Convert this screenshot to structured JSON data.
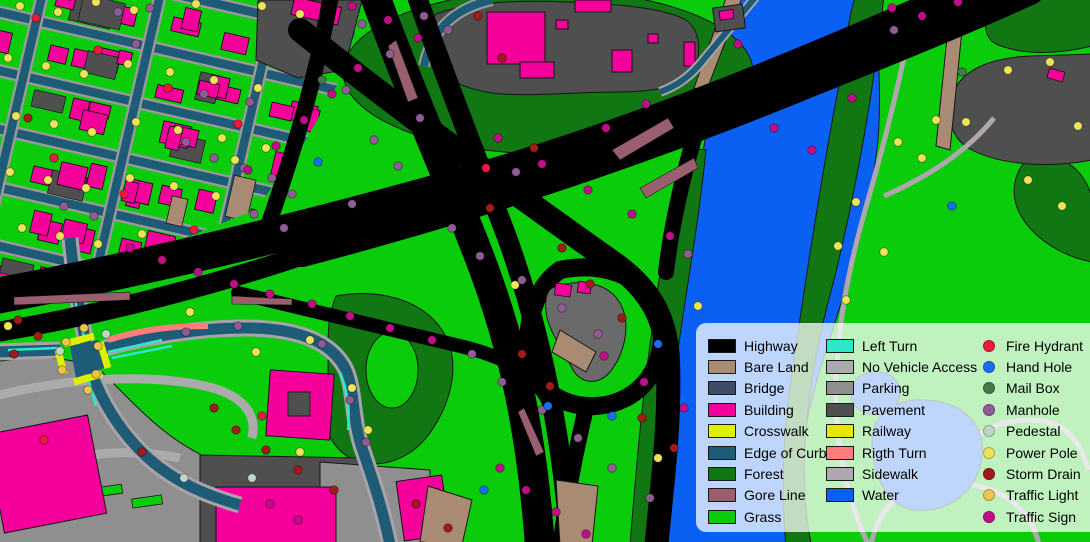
{
  "map": {
    "name": "land-cover-segmentation-map",
    "description": "Semantic segmentation map of a highway interchange beside a river with residential and commercial areas"
  },
  "palette": {
    "highway": "#000000",
    "bare_land": "#A88B72",
    "bridge": "#3C4B66",
    "building": "#F5009B",
    "crosswalk": "#DDF000",
    "edge_of_curb": "#1D5B76",
    "forest": "#107712",
    "gore_line": "#9A5F6F",
    "grass": "#0BCC0B",
    "left_turn": "#2EE6C8",
    "no_vehicle_access": "#ABABAB",
    "parking": "#8F8F8F",
    "pavement": "#4F4F4F",
    "railway": "#E6E600",
    "rigth_turn": "#FF7D7D",
    "sidewalk": "#AFA7AE",
    "water": "#0960F2",
    "fire_hydrant": "#ED1941",
    "hand_hole": "#1B6EF3",
    "mail_box": "#44784A",
    "manhole": "#8F5C96",
    "pedestal": "#BFD8C5",
    "power_pole": "#EDE45C",
    "storm_drain": "#A31A1A",
    "traffic_light": "#EDC44F",
    "traffic_sign": "#C00F86"
  },
  "legend": {
    "columns": [
      {
        "type": "swatch",
        "items": [
          {
            "key": "highway",
            "label": "Highway"
          },
          {
            "key": "bare_land",
            "label": "Bare Land"
          },
          {
            "key": "bridge",
            "label": "Bridge"
          },
          {
            "key": "building",
            "label": "Building"
          },
          {
            "key": "crosswalk",
            "label": "Crosswalk"
          },
          {
            "key": "edge_of_curb",
            "label": "Edge of Curb"
          },
          {
            "key": "forest",
            "label": "Forest"
          },
          {
            "key": "gore_line",
            "label": "Gore Line"
          },
          {
            "key": "grass",
            "label": "Grass"
          }
        ]
      },
      {
        "type": "swatch",
        "items": [
          {
            "key": "left_turn",
            "label": "Left Turn"
          },
          {
            "key": "no_vehicle_access",
            "label": "No Vehicle Access"
          },
          {
            "key": "parking",
            "label": "Parking"
          },
          {
            "key": "pavement",
            "label": "Pavement"
          },
          {
            "key": "railway",
            "label": "Railway"
          },
          {
            "key": "rigth_turn",
            "label": "Rigth Turn"
          },
          {
            "key": "sidewalk",
            "label": "Sidewalk"
          },
          {
            "key": "water",
            "label": "Water"
          }
        ]
      },
      {
        "type": "dot",
        "items": [
          {
            "key": "fire_hydrant",
            "label": "Fire Hydrant"
          },
          {
            "key": "hand_hole",
            "label": "Hand Hole"
          },
          {
            "key": "mail_box",
            "label": "Mail Box"
          },
          {
            "key": "manhole",
            "label": "Manhole"
          },
          {
            "key": "pedestal",
            "label": "Pedestal"
          },
          {
            "key": "power_pole",
            "label": "Power Pole"
          },
          {
            "key": "storm_drain",
            "label": "Storm Drain"
          },
          {
            "key": "traffic_light",
            "label": "Traffic Light"
          },
          {
            "key": "traffic_sign",
            "label": "Traffic Sign"
          }
        ]
      }
    ]
  },
  "map_points": {
    "power_pole": [
      [
        20,
        6
      ],
      [
        58,
        12
      ],
      [
        96,
        2
      ],
      [
        134,
        10
      ],
      [
        196,
        4
      ],
      [
        262,
        6
      ],
      [
        300,
        14
      ],
      [
        8,
        58
      ],
      [
        46,
        66
      ],
      [
        84,
        74
      ],
      [
        128,
        64
      ],
      [
        170,
        72
      ],
      [
        214,
        80
      ],
      [
        258,
        88
      ],
      [
        16,
        116
      ],
      [
        54,
        124
      ],
      [
        92,
        132
      ],
      [
        136,
        122
      ],
      [
        178,
        130
      ],
      [
        222,
        138
      ],
      [
        266,
        148
      ],
      [
        10,
        172
      ],
      [
        48,
        180
      ],
      [
        86,
        188
      ],
      [
        130,
        178
      ],
      [
        174,
        186
      ],
      [
        216,
        196
      ],
      [
        22,
        228
      ],
      [
        60,
        236
      ],
      [
        98,
        244
      ],
      [
        142,
        234
      ],
      [
        8,
        326
      ],
      [
        190,
        312
      ],
      [
        256,
        352
      ],
      [
        310,
        340
      ],
      [
        352,
        388
      ],
      [
        368,
        430
      ],
      [
        300,
        452
      ],
      [
        1008,
        70
      ],
      [
        1050,
        62
      ],
      [
        1078,
        126
      ],
      [
        936,
        120
      ],
      [
        966,
        122
      ],
      [
        898,
        142
      ],
      [
        922,
        158
      ],
      [
        856,
        202
      ],
      [
        838,
        246
      ],
      [
        884,
        252
      ],
      [
        846,
        300
      ],
      [
        658,
        458
      ],
      [
        698,
        306
      ],
      [
        1028,
        180
      ],
      [
        1062,
        206
      ],
      [
        515,
        285
      ],
      [
        235,
        160
      ]
    ],
    "manhole": [
      [
        150,
        8
      ],
      [
        136,
        44
      ],
      [
        118,
        12
      ],
      [
        204,
        94
      ],
      [
        250,
        102
      ],
      [
        186,
        142
      ],
      [
        214,
        158
      ],
      [
        244,
        168
      ],
      [
        272,
        178
      ],
      [
        292,
        194
      ],
      [
        64,
        206
      ],
      [
        94,
        216
      ],
      [
        254,
        214
      ],
      [
        284,
        228
      ],
      [
        362,
        24
      ],
      [
        390,
        54
      ],
      [
        346,
        90
      ],
      [
        420,
        118
      ],
      [
        374,
        140
      ],
      [
        398,
        166
      ],
      [
        352,
        204
      ],
      [
        452,
        228
      ],
      [
        480,
        256
      ],
      [
        522,
        280
      ],
      [
        562,
        308
      ],
      [
        598,
        334
      ],
      [
        472,
        354
      ],
      [
        502,
        382
      ],
      [
        542,
        410
      ],
      [
        578,
        438
      ],
      [
        612,
        468
      ],
      [
        650,
        498
      ],
      [
        688,
        254
      ],
      [
        894,
        30
      ],
      [
        186,
        332
      ],
      [
        238,
        326
      ],
      [
        322,
        344
      ],
      [
        350,
        400
      ],
      [
        366,
        442
      ],
      [
        424,
        16
      ],
      [
        448,
        30
      ],
      [
        516,
        172
      ]
    ],
    "storm_drain": [
      [
        28,
        118
      ],
      [
        18,
        320
      ],
      [
        38,
        336
      ],
      [
        14,
        354
      ],
      [
        478,
        16
      ],
      [
        502,
        58
      ],
      [
        534,
        148
      ],
      [
        490,
        208
      ],
      [
        562,
        248
      ],
      [
        590,
        284
      ],
      [
        622,
        318
      ],
      [
        522,
        354
      ],
      [
        550,
        386
      ],
      [
        642,
        418
      ],
      [
        674,
        448
      ],
      [
        416,
        504
      ],
      [
        448,
        528
      ],
      [
        214,
        408
      ],
      [
        236,
        430
      ],
      [
        266,
        450
      ],
      [
        298,
        470
      ],
      [
        334,
        490
      ],
      [
        142,
        452
      ]
    ],
    "traffic_sign": [
      [
        352,
        6
      ],
      [
        388,
        20
      ],
      [
        418,
        38
      ],
      [
        130,
        248
      ],
      [
        162,
        260
      ],
      [
        198,
        272
      ],
      [
        234,
        284
      ],
      [
        270,
        294
      ],
      [
        312,
        304
      ],
      [
        350,
        316
      ],
      [
        390,
        328
      ],
      [
        432,
        340
      ],
      [
        358,
        68
      ],
      [
        332,
        94
      ],
      [
        304,
        120
      ],
      [
        276,
        146
      ],
      [
        248,
        170
      ],
      [
        498,
        138
      ],
      [
        542,
        164
      ],
      [
        588,
        190
      ],
      [
        632,
        214
      ],
      [
        670,
        236
      ],
      [
        738,
        44
      ],
      [
        774,
        128
      ],
      [
        812,
        150
      ],
      [
        852,
        98
      ],
      [
        892,
        8
      ],
      [
        922,
        16
      ],
      [
        604,
        356
      ],
      [
        644,
        382
      ],
      [
        684,
        408
      ],
      [
        270,
        504
      ],
      [
        298,
        520
      ],
      [
        500,
        468
      ],
      [
        526,
        490
      ],
      [
        556,
        512
      ],
      [
        586,
        534
      ],
      [
        958,
        2
      ],
      [
        606,
        128
      ],
      [
        646,
        104
      ]
    ],
    "fire_hydrant": [
      [
        36,
        18
      ],
      [
        98,
        50
      ],
      [
        168,
        88
      ],
      [
        238,
        124
      ],
      [
        54,
        158
      ],
      [
        124,
        194
      ],
      [
        194,
        230
      ],
      [
        44,
        440
      ],
      [
        262,
        416
      ],
      [
        486,
        168
      ]
    ],
    "hand_hole": [
      [
        318,
        162
      ],
      [
        952,
        206
      ],
      [
        658,
        344
      ],
      [
        612,
        416
      ],
      [
        548,
        406
      ],
      [
        484,
        490
      ]
    ],
    "mail_box": [
      [
        322,
        80
      ],
      [
        962,
        72
      ]
    ],
    "pedestal": [
      [
        60,
        351
      ],
      [
        106,
        334
      ],
      [
        184,
        478
      ],
      [
        252,
        478
      ]
    ],
    "traffic_light": [
      [
        66,
        342
      ],
      [
        98,
        346
      ],
      [
        62,
        370
      ],
      [
        96,
        374
      ],
      [
        84,
        328
      ],
      [
        88,
        390
      ]
    ]
  }
}
